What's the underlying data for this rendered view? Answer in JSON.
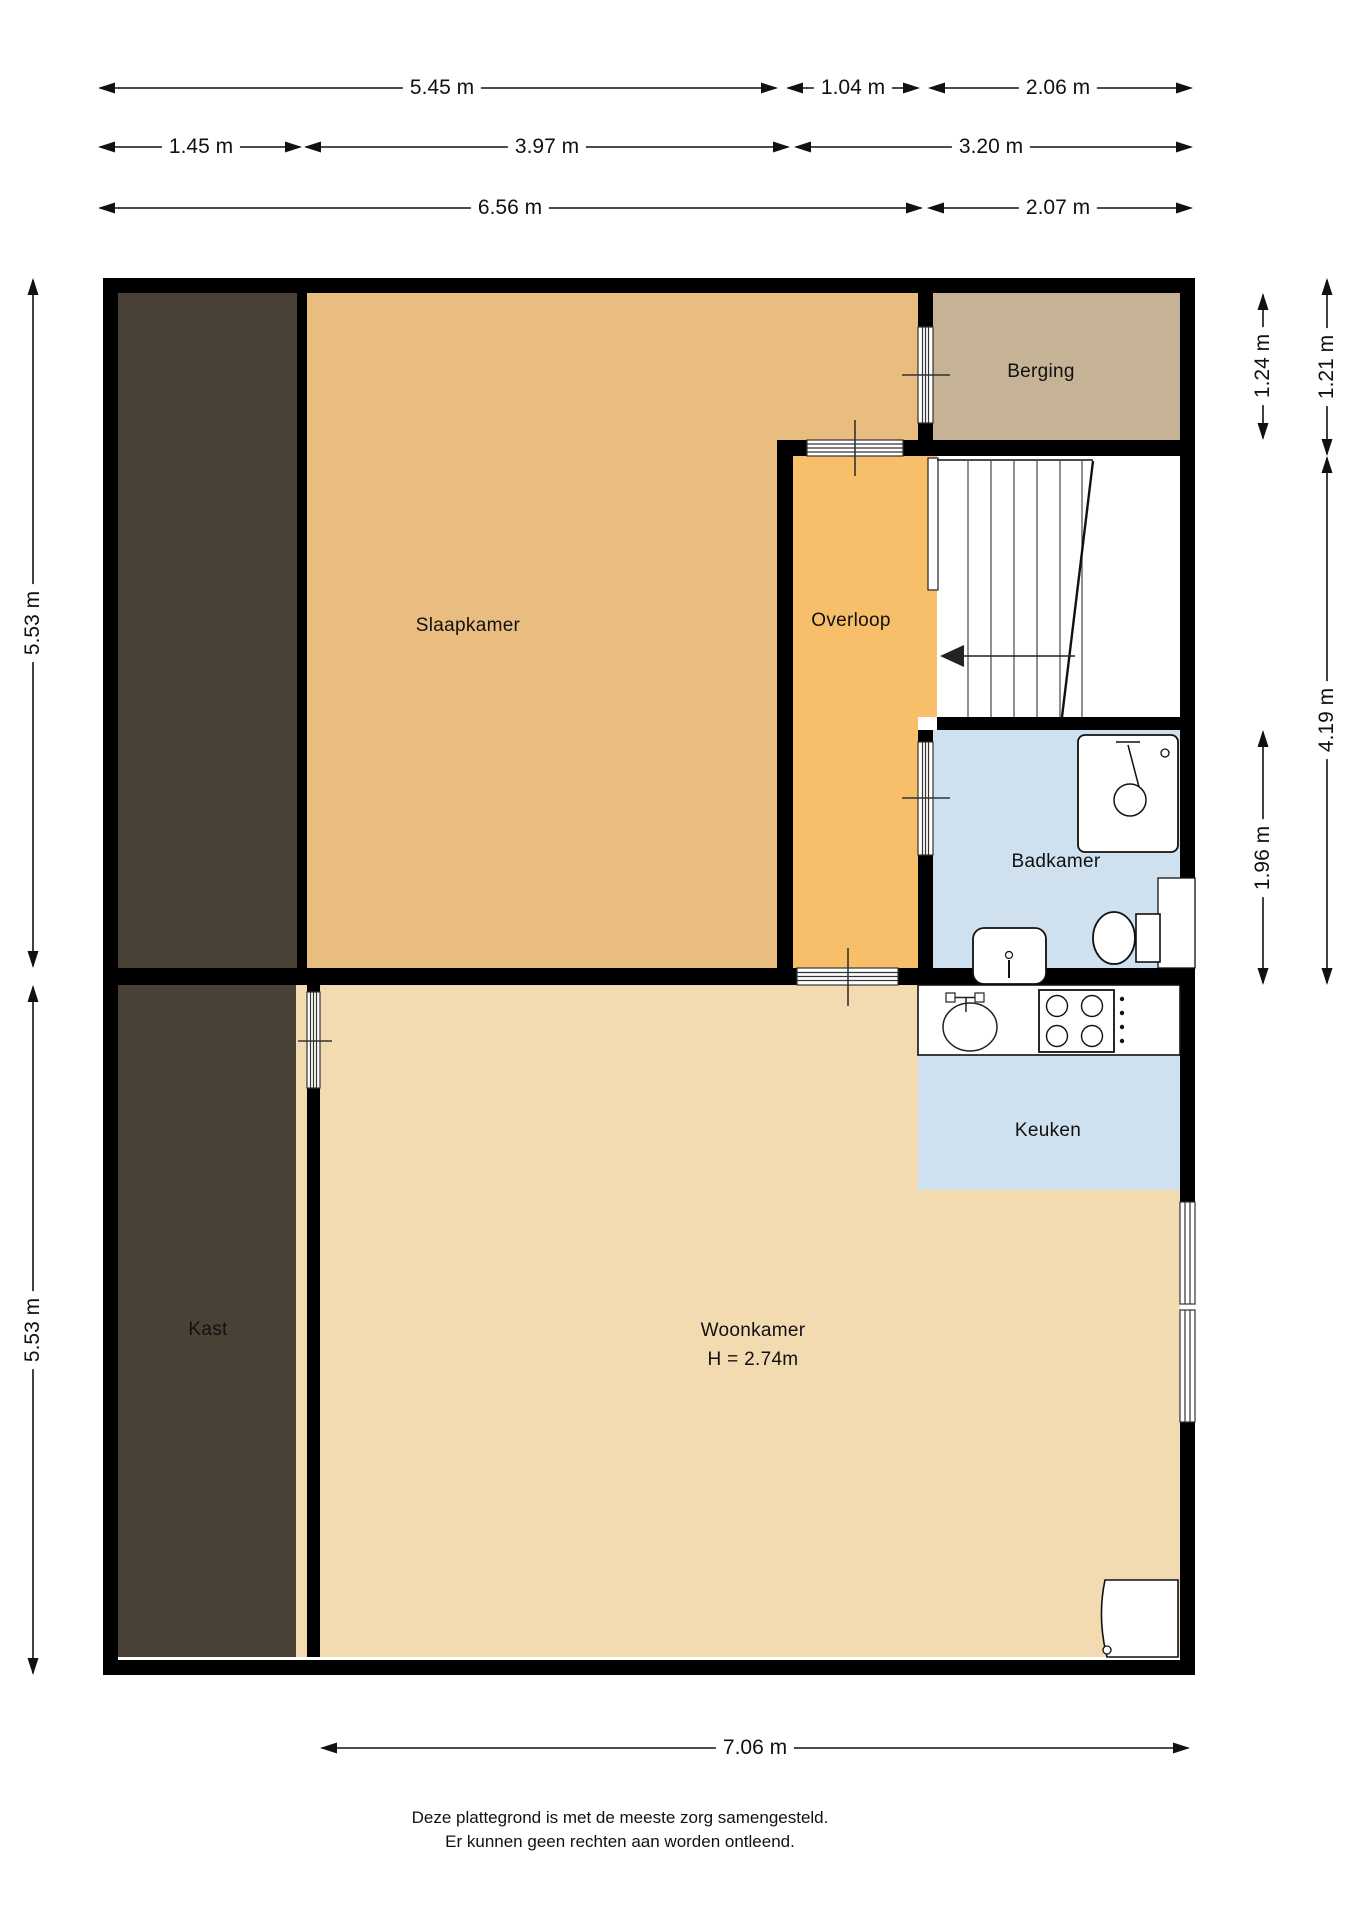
{
  "labels": {
    "slaapkamer": "Slaapkamer",
    "overloop": "Overloop",
    "berging": "Berging",
    "badkamer": "Badkamer",
    "keuken": "Keuken",
    "woonkamer": "Woonkamer",
    "woonkamer_height": "H = 2.74m",
    "kast": "Kast"
  },
  "dims": {
    "w545": "5.45 m",
    "w104": "1.04 m",
    "w206": "2.06 m",
    "w145": "1.45 m",
    "w397": "3.97 m",
    "w320": "3.20 m",
    "w656": "6.56 m",
    "w207": "2.07 m",
    "h553_top": "5.53 m",
    "h553_bottom": "5.53 m",
    "h124": "1.24 m",
    "h121": "1.21 m",
    "h419": "4.19 m",
    "h196": "1.96 m",
    "w706": "7.06 m"
  },
  "footer": {
    "line1": "Deze plattegrond is met de meeste zorg samengesteld.",
    "line2": "Er kunnen geen rechten aan worden ontleend."
  },
  "colors": {
    "wall": "#000000",
    "slaapkamer": "#e9bd80",
    "overloop": "#f7bf6a",
    "berging": "#c6b294",
    "closet": "#4a4136",
    "bathroom": "#cfe0ee",
    "kitchen": "#cfe0ee",
    "livingroom": "#f2dab1",
    "fixture": "#ffffff",
    "dimline": "#111111"
  }
}
